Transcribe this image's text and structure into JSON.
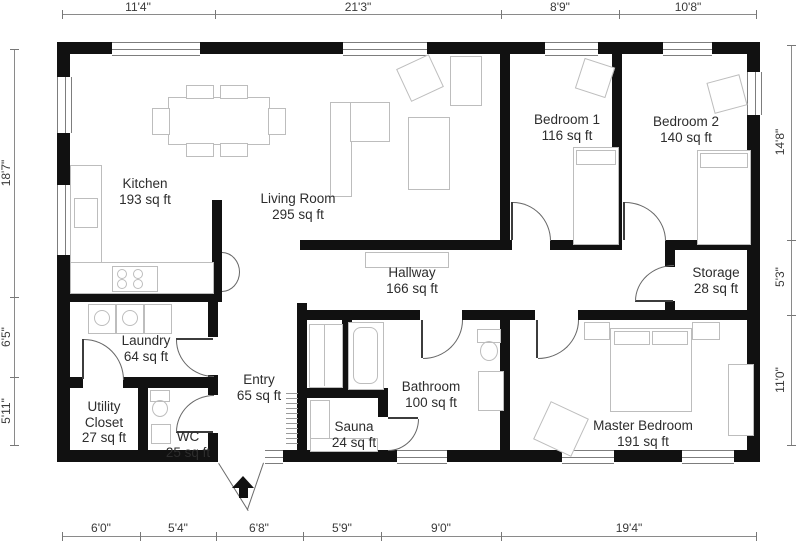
{
  "rooms": [
    {
      "name": "Kitchen",
      "area": "193 sq ft"
    },
    {
      "name": "Living Room",
      "area": "295 sq ft"
    },
    {
      "name": "Bedroom 1",
      "area": "116 sq ft"
    },
    {
      "name": "Bedroom 2",
      "area": "140 sq ft"
    },
    {
      "name": "Hallway",
      "area": "166 sq ft"
    },
    {
      "name": "Storage",
      "area": "28 sq ft"
    },
    {
      "name": "Laundry",
      "area": "64 sq ft"
    },
    {
      "name": "Entry",
      "area": "65 sq ft"
    },
    {
      "name": "Utility Closet",
      "area": "27 sq ft"
    },
    {
      "name": "WC",
      "area": "25 sq ft"
    },
    {
      "name": "Sauna",
      "area": "24 sq ft"
    },
    {
      "name": "Bathroom",
      "area": "100 sq ft"
    },
    {
      "name": "Master Bedroom",
      "area": "191 sq ft"
    }
  ],
  "dimensions": {
    "top": [
      "11'4\"",
      "21'3\"",
      "8'9\"",
      "10'8\""
    ],
    "bottom": [
      "6'0\"",
      "5'4\"",
      "6'8\"",
      "5'9\"",
      "9'0\"",
      "19'4\""
    ],
    "left": [
      "18'7\"",
      "6'5\"",
      "5'11\""
    ],
    "right": [
      "14'8\"",
      "5'3\"",
      "11'0\""
    ]
  },
  "colors": {
    "wall": "#111111",
    "furn": "#bdbdbd",
    "text": "#2d2d2d",
    "dim": "#8a8a8a",
    "door": "#666666"
  }
}
